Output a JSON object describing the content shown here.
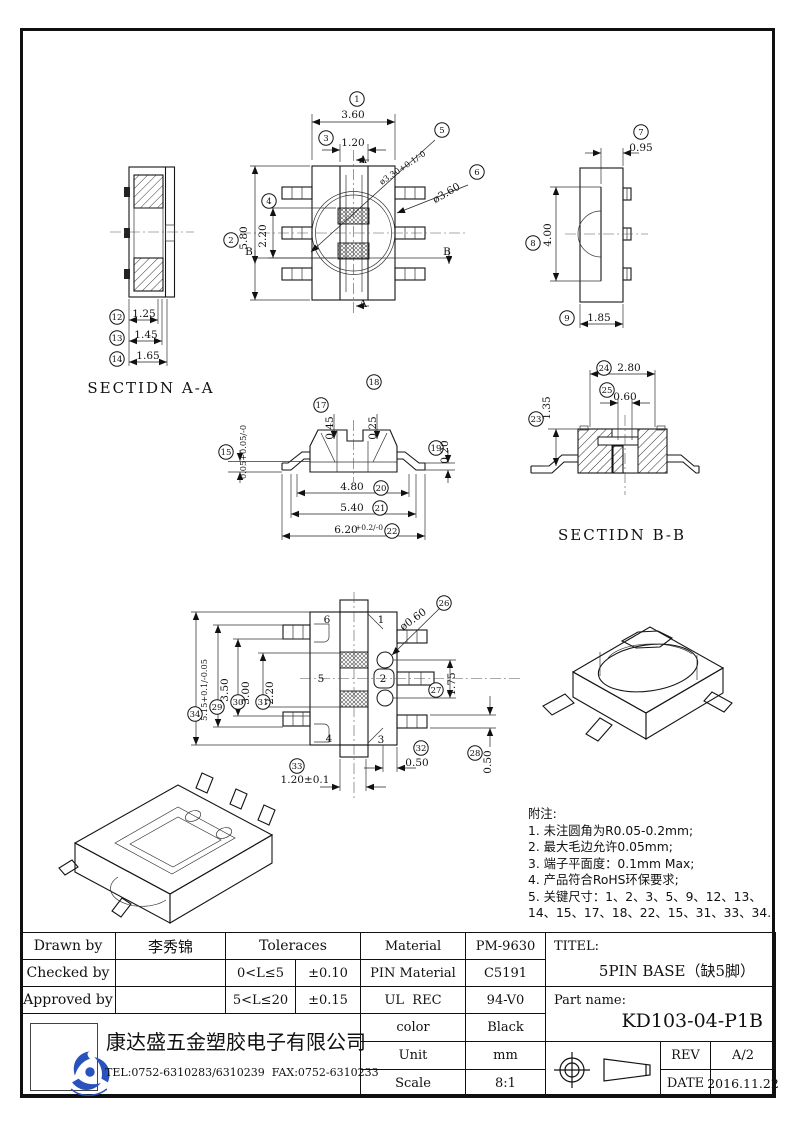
{
  "colors": {
    "line": "#111111",
    "logo_blue": "#2a52be"
  },
  "drawing": {
    "views": {
      "section_aa": {
        "ann": [
          {
            "c": "12",
            "x": 117,
            "y": 317
          },
          {
            "t": "1.25",
            "x": 144,
            "y": 317
          },
          {
            "c": "13",
            "x": 117,
            "y": 338
          },
          {
            "t": "1.45",
            "x": 146,
            "y": 338
          },
          {
            "c": "14",
            "x": 117,
            "y": 359
          },
          {
            "t": "1.65",
            "x": 148,
            "y": 359
          },
          {
            "t": "SECTIDN A-A",
            "x": 151,
            "y": 393,
            "cls": "view-label",
            "n": "section-aa-label"
          }
        ]
      },
      "top": {
        "ann": [
          {
            "c": "1",
            "x": 357,
            "y": 99
          },
          {
            "t": "3.60",
            "x": 353,
            "y": 118
          },
          {
            "c": "3",
            "x": 326,
            "y": 138
          },
          {
            "t": "1.20",
            "x": 353,
            "y": 146
          },
          {
            "c": "2",
            "x": 231,
            "y": 240
          },
          {
            "t": "5.80",
            "x": 247,
            "y": 238,
            "rot": -90
          },
          {
            "c": "4",
            "x": 269,
            "y": 201
          },
          {
            "t": "2.20",
            "x": 266,
            "y": 236,
            "rot": -90
          },
          {
            "c": "5",
            "x": 442,
            "y": 130
          },
          {
            "t": "ø3.30+0.1/-0",
            "x": 404,
            "y": 170,
            "rot": -34,
            "cls": "dim sm"
          },
          {
            "c": "6",
            "x": 477,
            "y": 172
          },
          {
            "t": "ø3.60",
            "x": 448,
            "y": 196,
            "rot": -30
          },
          {
            "t": "A",
            "x": 363,
            "y": 163
          },
          {
            "t": "A",
            "x": 363,
            "y": 307
          },
          {
            "t": "B",
            "x": 249,
            "y": 255
          },
          {
            "t": "B",
            "x": 447,
            "y": 255
          }
        ]
      },
      "side": {
        "ann": [
          {
            "c": "7",
            "x": 641,
            "y": 132
          },
          {
            "t": "0.95",
            "x": 641,
            "y": 151
          },
          {
            "c": "8",
            "x": 533,
            "y": 243
          },
          {
            "t": "4.00",
            "x": 551,
            "y": 235,
            "rot": -90
          },
          {
            "c": "9",
            "x": 567,
            "y": 318
          },
          {
            "t": "1.85",
            "x": 599,
            "y": 321
          }
        ]
      },
      "front": {
        "ann": [
          {
            "c": "15",
            "x": 226,
            "y": 452
          },
          {
            "t": "0.05+0.05/-0",
            "x": 246,
            "y": 452,
            "rot": -90,
            "cls": "dim sm"
          },
          {
            "c": "17",
            "x": 321,
            "y": 405
          },
          {
            "t": "0.45",
            "x": 333,
            "y": 428,
            "rot": -90
          },
          {
            "c": "18",
            "x": 374,
            "y": 382
          },
          {
            "t": "0.25",
            "x": 376,
            "y": 428,
            "rot": -90
          },
          {
            "c": "19",
            "x": 436,
            "y": 448
          },
          {
            "t": "0.20",
            "x": 448,
            "y": 452,
            "rot": -90
          },
          {
            "t": "4.80",
            "x": 352,
            "y": 490
          },
          {
            "c": "20",
            "x": 381,
            "y": 488
          },
          {
            "t": "5.40",
            "x": 352,
            "y": 511
          },
          {
            "c": "21",
            "x": 380,
            "y": 508
          },
          {
            "t": "6.20",
            "x": 346,
            "y": 533
          },
          {
            "t": "+0.2/-0",
            "x": 369,
            "y": 530,
            "cls": "dim tol"
          },
          {
            "c": "22",
            "x": 392,
            "y": 531
          }
        ]
      },
      "section_bb": {
        "ann": [
          {
            "c": "24",
            "x": 604,
            "y": 368
          },
          {
            "t": "2.80",
            "x": 629,
            "y": 371
          },
          {
            "c": "25",
            "x": 607,
            "y": 390
          },
          {
            "t": "0.60",
            "x": 625,
            "y": 400
          },
          {
            "c": "23",
            "x": 536,
            "y": 419
          },
          {
            "t": "1.35",
            "x": 550,
            "y": 408,
            "rot": -90
          },
          {
            "t": "SECTIDN B-B",
            "x": 622,
            "y": 540,
            "cls": "view-label",
            "n": "section-bb-label"
          }
        ]
      },
      "bottom": {
        "ann": [
          {
            "t": "6",
            "x": 327,
            "y": 623
          },
          {
            "t": "1",
            "x": 381,
            "y": 623
          },
          {
            "t": "5",
            "x": 321,
            "y": 682
          },
          {
            "t": "2",
            "x": 383,
            "y": 682
          },
          {
            "t": "4",
            "x": 329,
            "y": 742
          },
          {
            "t": "3",
            "x": 381,
            "y": 743
          },
          {
            "c": "26",
            "x": 444,
            "y": 603
          },
          {
            "t": "ø0.60",
            "x": 415,
            "y": 622,
            "rot": -36
          },
          {
            "c": "27",
            "x": 436,
            "y": 690
          },
          {
            "t": "1.75",
            "x": 455,
            "y": 684,
            "rot": -90
          },
          {
            "c": "28",
            "x": 475,
            "y": 753
          },
          {
            "t": "0.50",
            "x": 491,
            "y": 762,
            "rot": -90
          },
          {
            "c": "32",
            "x": 421,
            "y": 748
          },
          {
            "t": "0.50",
            "x": 417,
            "y": 766
          },
          {
            "c": "33",
            "x": 297,
            "y": 766
          },
          {
            "t": "1.20±0.1",
            "x": 305,
            "y": 783
          },
          {
            "c": "29",
            "x": 217,
            "y": 707
          },
          {
            "t": "3.50",
            "x": 228,
            "y": 690,
            "rot": -90
          },
          {
            "c": "30",
            "x": 238,
            "y": 702
          },
          {
            "t": "3.00",
            "x": 249,
            "y": 693,
            "rot": -90
          },
          {
            "c": "31",
            "x": 263,
            "y": 702
          },
          {
            "t": "2.20",
            "x": 273,
            "y": 693,
            "rot": -90
          },
          {
            "c": "34",
            "x": 195,
            "y": 714
          },
          {
            "t": "5.15+0.1/-0.05",
            "x": 207,
            "y": 690,
            "rot": -90,
            "cls": "dim sm"
          }
        ]
      }
    }
  },
  "notes": {
    "title": "附注:",
    "lines": [
      "1. 未注圆角为R0.05-0.2mm;",
      "2. 最大毛边允许0.05mm;",
      "3. 端子平面度：0.1mm Max;",
      "4. 产品符合RoHS环保要求;",
      "5. 关键尺寸：1、2、3、5、9、12、13、",
      "    14、15、17、18、22、15、31、33、34."
    ]
  },
  "title_block": {
    "drawn_by_label": "Drawn by",
    "drawn_by_value": "李秀锦",
    "checked_by_label": "Checked by",
    "checked_by_value": "",
    "approved_by_label": "Approved by",
    "approved_by_value": "",
    "tolerances_label": "Toleraces",
    "tol_range_1": "0<L≤5",
    "tol_value_1": "±0.10",
    "tol_range_2": "5<L≤20",
    "tol_value_2": "±0.15",
    "material_label": "Material",
    "material_value": "PM-9630",
    "pin_material_label": "PIN Material",
    "pin_material_value": "C5191",
    "ul_rec_label": "UL  REC",
    "ul_rec_value": "94-V0",
    "color_label": "color",
    "color_value": "Black",
    "unit_label": "Unit",
    "unit_value": "mm",
    "scale_label": "Scale",
    "scale_value": "8:1",
    "titel_label": "TITEL:",
    "titel_value": "5PIN BASE（缺5脚）",
    "part_name_label": "Part name:",
    "part_name_value": "KD103-04-P1B",
    "rev_label": "REV",
    "rev_value": "A/2",
    "date_label": "DATE",
    "date_value": "2016.11.22"
  },
  "company": {
    "name": "康达盛五金塑胶电子有限公司",
    "contact": "TEL:0752-6310283/6310239  FAX:0752-6310233"
  }
}
